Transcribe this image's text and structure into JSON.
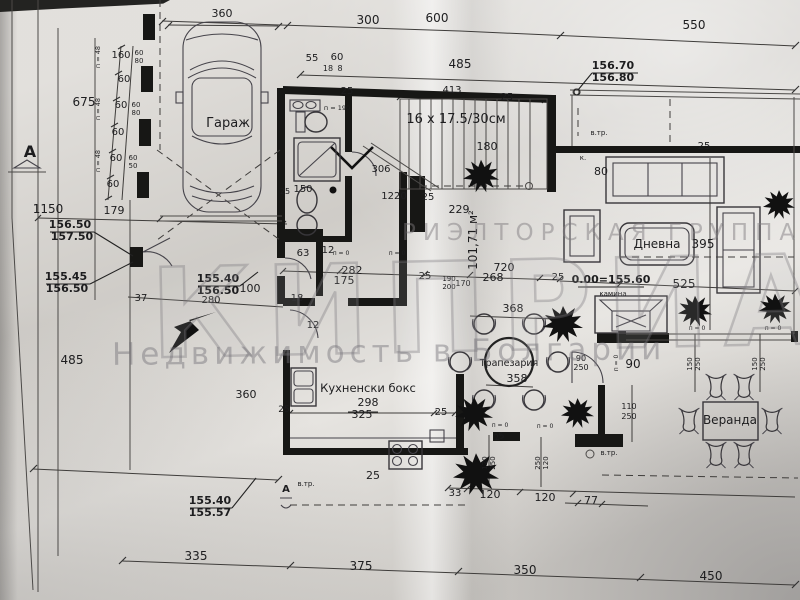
{
  "watermark": {
    "line1": "РИЭЛТОРСКАЯ ГРУППА",
    "big": "КИПРИАН",
    "line2": "Недвижимость в Болгарии"
  },
  "rooms": {
    "garage": "Гараж",
    "living": "Дневна",
    "dining": "Трапезария",
    "kitchen": "Кухненски бокс",
    "veranda": "Веранда"
  },
  "notes": {
    "stairs": "16 х 17.5/30см",
    "floor_area": "101,71 м²",
    "level": "0.00=155.60",
    "fireplace": "камина"
  },
  "elevation_marks": [
    {
      "top": "156.70",
      "bottom": "156.80"
    },
    {
      "top": "156.50",
      "bottom": "157.50"
    },
    {
      "top": "155.45",
      "bottom": "156.50"
    },
    {
      "top": "155.40",
      "bottom": "156.50"
    },
    {
      "top": "155.40",
      "bottom": "155.57"
    }
  ],
  "annotations": [
    {
      "t": "360",
      "x": 222,
      "y": 17,
      "s": 11
    },
    {
      "t": "300",
      "x": 368,
      "y": 24,
      "s": 12
    },
    {
      "t": "600",
      "x": 437,
      "y": 22,
      "s": 12
    },
    {
      "t": "550",
      "x": 694,
      "y": 29,
      "s": 12
    },
    {
      "t": "485",
      "x": 460,
      "y": 68,
      "s": 12
    },
    {
      "t": "55",
      "x": 312,
      "y": 61,
      "s": 10
    },
    {
      "t": "60",
      "x": 337,
      "y": 60,
      "s": 10
    },
    {
      "t": "18",
      "x": 328,
      "y": 71,
      "s": 8
    },
    {
      "t": "8",
      "x": 340,
      "y": 71,
      "s": 8
    },
    {
      "t": "160",
      "x": 121,
      "y": 58,
      "s": 10
    },
    {
      "t": "60",
      "x": 124,
      "y": 82,
      "s": 10
    },
    {
      "t": "60",
      "x": 121,
      "y": 108,
      "s": 10
    },
    {
      "t": "60",
      "x": 118,
      "y": 135,
      "s": 10
    },
    {
      "t": "60",
      "x": 116,
      "y": 161,
      "s": 10
    },
    {
      "t": "60",
      "x": 113,
      "y": 187,
      "s": 10
    },
    {
      "t": "60",
      "x": 139,
      "y": 55,
      "s": 7
    },
    {
      "t": "80",
      "x": 139,
      "y": 63,
      "s": 7
    },
    {
      "t": "60",
      "x": 136,
      "y": 107,
      "s": 7
    },
    {
      "t": "80",
      "x": 136,
      "y": 115,
      "s": 7
    },
    {
      "t": "60",
      "x": 133,
      "y": 160,
      "s": 7
    },
    {
      "t": "50",
      "x": 133,
      "y": 168,
      "s": 7
    },
    {
      "t": "п = 48",
      "x": 100,
      "y": 57,
      "s": 6.5,
      "r": -90
    },
    {
      "t": "п = 48",
      "x": 100,
      "y": 109,
      "s": 6.5,
      "r": -90
    },
    {
      "t": "п = 48",
      "x": 100,
      "y": 161,
      "s": 6.5,
      "r": -90
    },
    {
      "t": "675",
      "x": 84,
      "y": 106,
      "s": 12
    },
    {
      "t": "1150",
      "x": 48,
      "y": 213,
      "s": 12
    },
    {
      "t": "179",
      "x": 114,
      "y": 214,
      "s": 11
    },
    {
      "t": "485",
      "x": 72,
      "y": 364,
      "s": 12
    },
    {
      "t": "А",
      "x": 30,
      "y": 157,
      "s": 16,
      "w": 1,
      "n": "section-mark-a-label"
    },
    {
      "t": "25",
      "x": 347,
      "y": 94,
      "s": 10
    },
    {
      "t": "25",
      "x": 507,
      "y": 100,
      "s": 10
    },
    {
      "t": "413",
      "x": 452,
      "y": 93,
      "s": 10
    },
    {
      "t": "16 х 17.5/30см",
      "x": 456,
      "y": 123,
      "s": 13,
      "n": "stairs-note"
    },
    {
      "t": "180",
      "x": 487,
      "y": 150,
      "s": 11
    },
    {
      "t": "80",
      "x": 601,
      "y": 175,
      "s": 11
    },
    {
      "t": "25",
      "x": 704,
      "y": 149,
      "s": 10
    },
    {
      "t": "в.тр.",
      "x": 599,
      "y": 135,
      "s": 7
    },
    {
      "t": "к.",
      "x": 583,
      "y": 160,
      "s": 7
    },
    {
      "t": "306",
      "x": 381,
      "y": 172,
      "s": 10
    },
    {
      "t": "1220",
      "x": 394,
      "y": 199,
      "s": 10
    },
    {
      "t": "25",
      "x": 428,
      "y": 200,
      "s": 10
    },
    {
      "t": "229",
      "x": 459,
      "y": 213,
      "s": 11
    },
    {
      "t": "п = 190",
      "x": 337,
      "y": 110,
      "s": 6.5
    },
    {
      "t": "150",
      "x": 303,
      "y": 192,
      "s": 10
    },
    {
      "t": "25",
      "x": 285,
      "y": 194,
      "s": 8
    },
    {
      "t": "63",
      "x": 303,
      "y": 256,
      "s": 10
    },
    {
      "t": "12",
      "x": 328,
      "y": 253,
      "s": 10
    },
    {
      "t": "п = 0",
      "x": 341,
      "y": 255,
      "s": 6
    },
    {
      "t": "п = 0",
      "x": 397,
      "y": 255,
      "s": 6
    },
    {
      "t": "282",
      "x": 352,
      "y": 274,
      "s": 11
    },
    {
      "t": "175",
      "x": 344,
      "y": 284,
      "s": 11
    },
    {
      "t": "25",
      "x": 425,
      "y": 279,
      "s": 10
    },
    {
      "t": "190",
      "x": 449,
      "y": 281,
      "s": 7
    },
    {
      "t": "200",
      "x": 449,
      "y": 289,
      "s": 7
    },
    {
      "t": "170",
      "x": 463,
      "y": 286,
      "s": 8
    },
    {
      "t": "101,71 м²",
      "x": 477,
      "y": 240,
      "s": 12,
      "r": -90,
      "n": "floor-area-label"
    },
    {
      "t": "720",
      "x": 504,
      "y": 271,
      "s": 11
    },
    {
      "t": "268",
      "x": 493,
      "y": 281,
      "s": 11
    },
    {
      "t": "25",
      "x": 558,
      "y": 280,
      "s": 10
    },
    {
      "t": "18",
      "x": 297,
      "y": 301,
      "s": 10
    },
    {
      "t": "12",
      "x": 313,
      "y": 328,
      "s": 10
    },
    {
      "t": "100",
      "x": 250,
      "y": 292,
      "s": 11
    },
    {
      "t": "37",
      "x": 141,
      "y": 301,
      "s": 10
    },
    {
      "t": "280",
      "x": 211,
      "y": 303,
      "s": 10
    },
    {
      "t": "360",
      "x": 246,
      "y": 398,
      "s": 11
    },
    {
      "t": "Гараж",
      "x": 228,
      "y": 127,
      "s": 13,
      "n": "room-label-garage"
    },
    {
      "t": "Дневна",
      "x": 657,
      "y": 248,
      "s": 12,
      "n": "room-label-living"
    },
    {
      "t": "395",
      "x": 703,
      "y": 248,
      "s": 12
    },
    {
      "t": "525",
      "x": 684,
      "y": 288,
      "s": 12
    },
    {
      "t": "0.00=155.60",
      "x": 611,
      "y": 283,
      "s": 11,
      "w": 1,
      "n": "level-note"
    },
    {
      "t": "камина",
      "x": 613,
      "y": 296,
      "s": 7,
      "n": "fireplace-label"
    },
    {
      "t": "Трапезария",
      "x": 509,
      "y": 366,
      "s": 9.5,
      "n": "room-label-dining"
    },
    {
      "t": "368",
      "x": 513,
      "y": 312,
      "s": 11
    },
    {
      "t": "358",
      "x": 517,
      "y": 382,
      "s": 11
    },
    {
      "t": "90",
      "x": 581,
      "y": 361,
      "s": 8
    },
    {
      "t": "250",
      "x": 581,
      "y": 370,
      "s": 8
    },
    {
      "t": "90",
      "x": 633,
      "y": 368,
      "s": 12
    },
    {
      "t": "110",
      "x": 629,
      "y": 409,
      "s": 8
    },
    {
      "t": "250",
      "x": 629,
      "y": 419,
      "s": 8
    },
    {
      "t": "150",
      "x": 692,
      "y": 364,
      "s": 7,
      "r": -90
    },
    {
      "t": "250",
      "x": 700,
      "y": 364,
      "s": 7,
      "r": -90
    },
    {
      "t": "150",
      "x": 757,
      "y": 364,
      "s": 7,
      "r": -90
    },
    {
      "t": "250",
      "x": 765,
      "y": 364,
      "s": 7,
      "r": -90
    },
    {
      "t": "п = 0",
      "x": 697,
      "y": 330,
      "s": 6
    },
    {
      "t": "п = 0",
      "x": 773,
      "y": 330,
      "s": 6
    },
    {
      "t": "п = 0",
      "x": 500,
      "y": 427,
      "s": 6
    },
    {
      "t": "п = 0",
      "x": 545,
      "y": 428,
      "s": 6
    },
    {
      "t": "п = 0",
      "x": 618,
      "y": 363,
      "s": 6,
      "r": -90
    },
    {
      "t": "Кухненски бокс",
      "x": 368,
      "y": 392,
      "s": 11.5,
      "n": "room-label-kitchen"
    },
    {
      "t": "298",
      "x": 368,
      "y": 406,
      "s": 11
    },
    {
      "t": "325",
      "x": 362,
      "y": 418,
      "s": 11
    },
    {
      "t": "25",
      "x": 284,
      "y": 412,
      "s": 9
    },
    {
      "t": "25",
      "x": 441,
      "y": 415,
      "s": 10
    },
    {
      "t": "25",
      "x": 373,
      "y": 479,
      "s": 11
    },
    {
      "t": "в.тр.",
      "x": 306,
      "y": 486,
      "s": 7
    },
    {
      "t": "А",
      "x": 286,
      "y": 492,
      "s": 10,
      "w": 1,
      "n": "section-mark-a-label"
    },
    {
      "t": "в.тр.",
      "x": 609,
      "y": 455,
      "s": 7
    },
    {
      "t": "Веранда",
      "x": 730,
      "y": 424,
      "s": 12,
      "n": "room-label-veranda"
    },
    {
      "t": "33",
      "x": 455,
      "y": 496,
      "s": 10
    },
    {
      "t": "120",
      "x": 490,
      "y": 498,
      "s": 11
    },
    {
      "t": "120",
      "x": 545,
      "y": 501,
      "s": 11
    },
    {
      "t": "25",
      "x": 500,
      "y": 439,
      "s": 8,
      "r": -18
    },
    {
      "t": "120",
      "x": 487,
      "y": 463,
      "s": 7,
      "r": -90
    },
    {
      "t": "250",
      "x": 495,
      "y": 463,
      "s": 7,
      "r": -90
    },
    {
      "t": "250",
      "x": 540,
      "y": 463,
      "s": 7,
      "r": -90
    },
    {
      "t": "120",
      "x": 548,
      "y": 463,
      "s": 7,
      "r": -90
    },
    {
      "t": "77",
      "x": 591,
      "y": 504,
      "s": 11
    },
    {
      "t": "335",
      "x": 196,
      "y": 560,
      "s": 12
    },
    {
      "t": "375",
      "x": 361,
      "y": 570,
      "s": 12
    },
    {
      "t": "350",
      "x": 525,
      "y": 574,
      "s": 12
    },
    {
      "t": "450",
      "x": 711,
      "y": 580,
      "s": 12
    },
    {
      "t": "156.70",
      "x": 613,
      "y": 69,
      "s": 11,
      "w": 1,
      "n": "elevation-mark"
    },
    {
      "t": "156.80",
      "x": 613,
      "y": 81,
      "s": 11,
      "w": 1,
      "n": "elevation-mark"
    },
    {
      "t": "156.50",
      "x": 70,
      "y": 228,
      "s": 11,
      "w": 1,
      "n": "elevation-mark"
    },
    {
      "t": "157.50",
      "x": 72,
      "y": 240,
      "s": 11,
      "w": 1,
      "n": "elevation-mark"
    },
    {
      "t": "155.45",
      "x": 66,
      "y": 280,
      "s": 11,
      "w": 1,
      "n": "elevation-mark"
    },
    {
      "t": "156.50",
      "x": 67,
      "y": 292,
      "s": 11,
      "w": 1,
      "n": "elevation-mark"
    },
    {
      "t": "155.40",
      "x": 218,
      "y": 282,
      "s": 11,
      "w": 1,
      "n": "elevation-mark"
    },
    {
      "t": "156.50",
      "x": 218,
      "y": 294,
      "s": 11,
      "w": 1,
      "n": "elevation-mark"
    },
    {
      "t": "155.40",
      "x": 210,
      "y": 504,
      "s": 11,
      "w": 1,
      "n": "elevation-mark"
    },
    {
      "t": "155.57",
      "x": 210,
      "y": 516,
      "s": 11,
      "w": 1,
      "n": "elevation-mark"
    }
  ]
}
